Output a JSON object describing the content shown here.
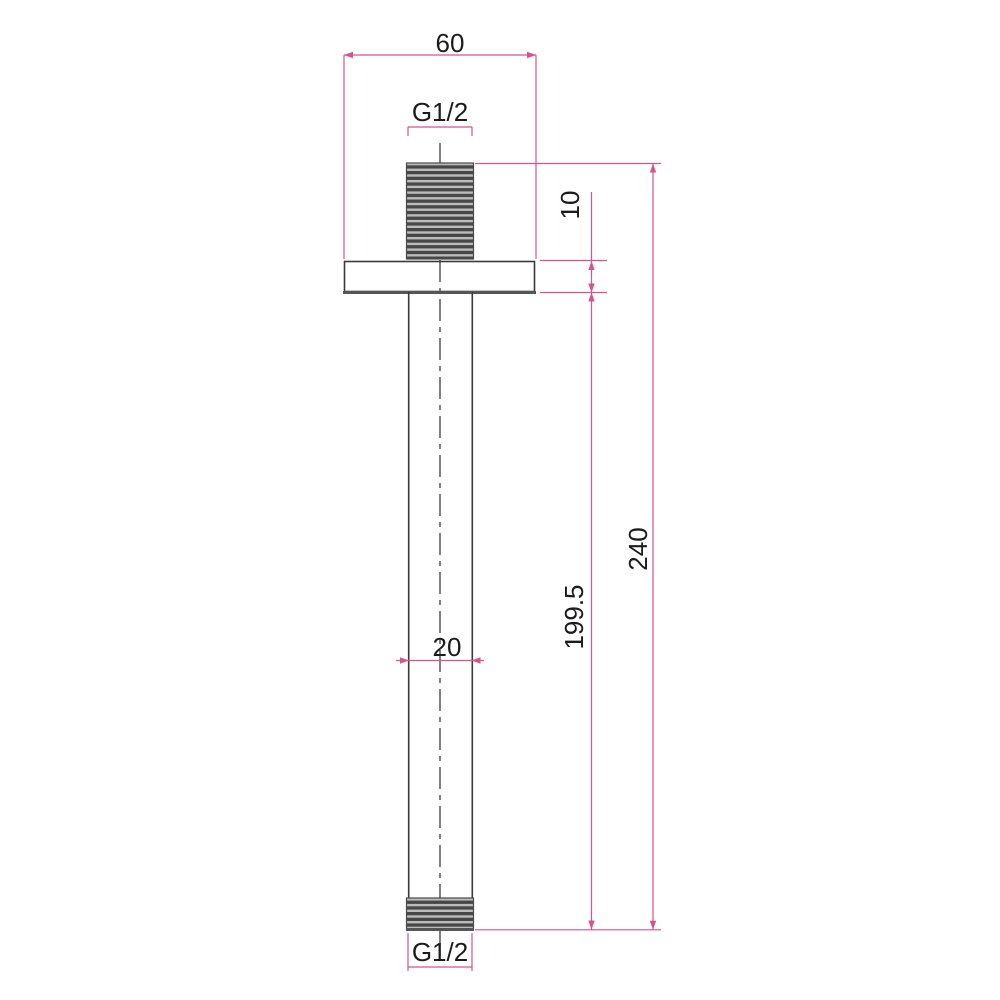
{
  "dimensions": {
    "top_width": "60",
    "top_thread": "G1/2",
    "flange_thickness": "10",
    "tube_diameter": "20",
    "arm_length": "199.5",
    "overall_length": "240",
    "bottom_thread": "G1/2"
  },
  "colors": {
    "dimension_line": "#d6548b",
    "object_line": "#3a3a3a",
    "text": "#1c1c1c",
    "background": "#ffffff"
  }
}
